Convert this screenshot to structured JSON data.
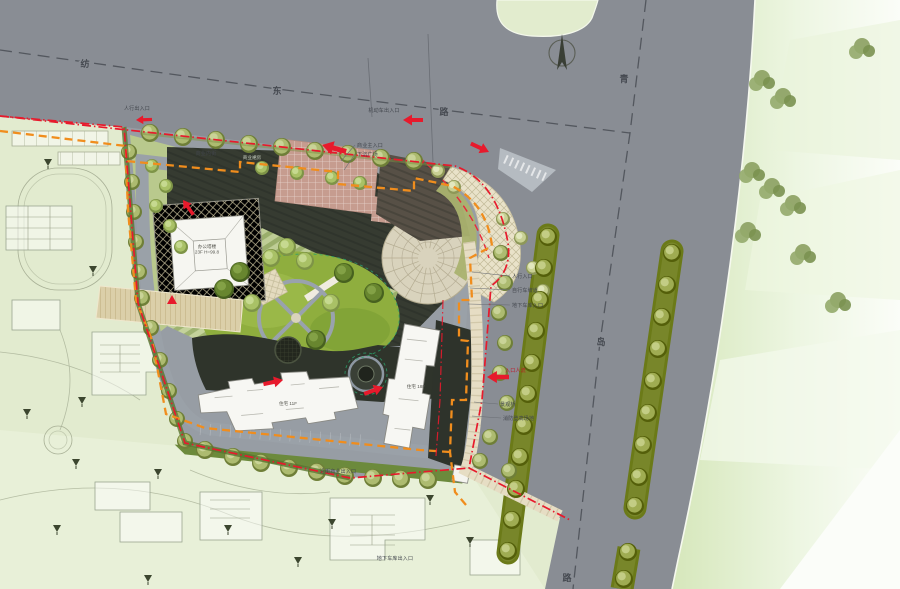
{
  "plan": {
    "type": "architectural-site-master-plan",
    "colors": {
      "road": "#898d94",
      "context_green": "#e2ebcf",
      "field_green": "#dcebc2",
      "garden_green": "#8fae3e",
      "terrace_light": "#c6d59b",
      "terrace_dark": "#9fb46e",
      "shadow_dark": "#363b31",
      "tower_white": "#f6f6f1",
      "plaza_pink": "#c69c8f",
      "fan_cream": "#e9e2c9",
      "median_olive": "#6b7a18",
      "boundary_red": "#e71a2c",
      "fire_lane_orange": "#f08d1d"
    },
    "north_arrow": {
      "x": 562,
      "y": 53
    },
    "road_labels": [
      {
        "text": "纺",
        "x": 85,
        "y": 67
      },
      {
        "text": "东",
        "x": 277,
        "y": 94
      },
      {
        "text": "路",
        "x": 444,
        "y": 115
      },
      {
        "text": "青",
        "x": 624,
        "y": 82
      },
      {
        "text": "岛",
        "x": 601,
        "y": 345
      },
      {
        "text": "路",
        "x": 567,
        "y": 581
      }
    ],
    "annotations": [
      {
        "t": "机动车出入口",
        "x": 384,
        "y": 112,
        "c": "#41454c",
        "anchor": "middle"
      },
      {
        "t": "人行出入口",
        "x": 137,
        "y": 110,
        "c": "#41454c",
        "anchor": "middle"
      },
      {
        "t": "商业主入口",
        "x": 357,
        "y": 147,
        "c": "#41454c",
        "anchor": "start",
        "lx": 341,
        "ly": 161
      },
      {
        "t": "下沉广场",
        "x": 357,
        "y": 156,
        "c": "#41454c",
        "anchor": "start",
        "lx": 344,
        "ly": 170
      },
      {
        "t": "商业内街",
        "x": 206,
        "y": 155,
        "c": "#41454c",
        "anchor": "middle"
      },
      {
        "t": "人行入口",
        "x": 512,
        "y": 278,
        "c": "#41454c",
        "anchor": "start",
        "lx": 472,
        "ly": 272
      },
      {
        "t": "自行车坡道",
        "x": 512,
        "y": 292,
        "c": "#41454c",
        "anchor": "start",
        "lx": 470,
        "ly": 288
      },
      {
        "t": "地下车库入口",
        "x": 512,
        "y": 307,
        "c": "#41454c",
        "anchor": "start",
        "lx": 468,
        "ly": 304
      },
      {
        "t": "入口人流",
        "x": 505,
        "y": 372,
        "c": "#c01325",
        "anchor": "start"
      },
      {
        "t": "景观桥",
        "x": 500,
        "y": 406,
        "c": "#41454c",
        "anchor": "start",
        "lx": 474,
        "ly": 402
      },
      {
        "t": "消防登高场地",
        "x": 503,
        "y": 420,
        "c": "#41454c",
        "anchor": "start",
        "lx": 472,
        "ly": 416
      },
      {
        "t": "沿街商业出入口",
        "x": 338,
        "y": 473,
        "c": "#41454c",
        "anchor": "middle"
      },
      {
        "t": "地下车库出入口",
        "x": 395,
        "y": 560,
        "c": "#41454c",
        "anchor": "middle"
      }
    ],
    "building_labels": [
      {
        "lines": [
          "办公塔楼",
          "23F  H=99.8"
        ],
        "x": 207,
        "y": 248,
        "color": "#55554e"
      },
      {
        "lines": [
          "商业裙房"
        ],
        "x": 252,
        "y": 159,
        "color": "#c7cdbf"
      },
      {
        "lines": [
          "住宅 11F"
        ],
        "x": 288,
        "y": 405,
        "color": "#55554e"
      },
      {
        "lines": [
          "住宅 18F"
        ],
        "x": 416,
        "y": 388,
        "color": "#55554e"
      }
    ],
    "entrance_arrows": [
      {
        "x": 403,
        "y": 120,
        "a": 180,
        "s": 1
      },
      {
        "x": 322,
        "y": 145,
        "a": 195,
        "s": 1.25
      },
      {
        "x": 489,
        "y": 152,
        "a": 25,
        "s": 1
      },
      {
        "x": 487,
        "y": 377,
        "a": 180,
        "s": 1.1
      },
      {
        "x": 283,
        "y": 380,
        "a": -12,
        "s": 1
      },
      {
        "x": 383,
        "y": 387,
        "a": -20,
        "s": 1
      },
      {
        "x": 136,
        "y": 120,
        "a": 178,
        "s": 0.8
      },
      {
        "x": 183,
        "y": 200,
        "a": 235,
        "s": 0.9
      },
      {
        "x": 172,
        "y": 300,
        "a": 0,
        "s": 1,
        "type": "tri"
      }
    ],
    "trees": {
      "site_row_north": {
        "style": "olive",
        "r": 9,
        "pts": [
          [
            150,
            133
          ],
          [
            183,
            137
          ],
          [
            216,
            140
          ],
          [
            249,
            144
          ],
          [
            282,
            147
          ],
          [
            315,
            151
          ],
          [
            348,
            154
          ],
          [
            381,
            158
          ],
          [
            414,
            161
          ]
        ]
      },
      "site_row_west": {
        "style": "olive",
        "r": 8,
        "pts": [
          [
            129,
            152
          ],
          [
            132,
            182
          ],
          [
            134,
            212
          ],
          [
            136,
            242
          ],
          [
            139,
            272
          ],
          [
            142,
            298
          ]
        ]
      },
      "hedge_sw": {
        "style": "olive",
        "r": 8,
        "pts": [
          [
            151,
            328
          ],
          [
            160,
            360
          ],
          [
            169,
            391
          ],
          [
            177,
            419
          ],
          [
            185,
            441
          ]
        ]
      },
      "site_row_south": {
        "style": "olive",
        "r": 9,
        "pts": [
          [
            205,
            450
          ],
          [
            233,
            457
          ],
          [
            261,
            463
          ],
          [
            289,
            468
          ],
          [
            317,
            472
          ],
          [
            345,
            476
          ],
          [
            373,
            478
          ],
          [
            401,
            479
          ],
          [
            428,
            480
          ]
        ]
      },
      "nw_wedge": {
        "style": "light",
        "r": 7,
        "pts": [
          [
            152,
            166
          ],
          [
            166,
            186
          ],
          [
            156,
            206
          ],
          [
            170,
            226
          ],
          [
            181,
            247
          ]
        ]
      },
      "north_street": {
        "style": "light",
        "r": 7,
        "pts": [
          [
            262,
            168
          ],
          [
            297,
            173
          ],
          [
            332,
            178
          ],
          [
            360,
            183
          ]
        ]
      },
      "garden_dark": {
        "style": "dark",
        "r": 10,
        "pts": [
          [
            240,
            272
          ],
          [
            344,
            273
          ],
          [
            374,
            293
          ],
          [
            224,
            289
          ],
          [
            316,
            340
          ]
        ]
      },
      "garden_light": {
        "style": "light",
        "r": 9,
        "pts": [
          [
            271,
            258
          ],
          [
            305,
            261
          ],
          [
            331,
            303
          ],
          [
            252,
            303
          ],
          [
            287,
            247
          ]
        ]
      },
      "fan_area": {
        "style": "cream",
        "r": 7,
        "pts": [
          [
            438,
            171
          ],
          [
            454,
            187
          ],
          [
            521,
            238
          ],
          [
            533,
            268
          ],
          [
            543,
            291
          ],
          [
            503,
            219
          ]
        ]
      },
      "east_walk": {
        "style": "olive",
        "r": 8,
        "pts": [
          [
            501,
            253
          ],
          [
            505,
            283
          ],
          [
            499,
            313
          ],
          [
            505,
            343
          ],
          [
            500,
            373
          ],
          [
            507,
            403
          ],
          [
            490,
            437
          ],
          [
            480,
            461
          ],
          [
            509,
            471
          ]
        ]
      },
      "median1": {
        "style": "median",
        "r": 9,
        "pts": [
          [
            548,
            237
          ],
          [
            544,
            268
          ],
          [
            540,
            300
          ],
          [
            536,
            331
          ],
          [
            532,
            363
          ],
          [
            528,
            394
          ],
          [
            524,
            426
          ],
          [
            520,
            457
          ],
          [
            516,
            489
          ],
          [
            512,
            520
          ],
          [
            508,
            551
          ]
        ]
      },
      "median2": {
        "style": "median",
        "r": 9,
        "pts": [
          [
            672,
            253
          ],
          [
            667,
            285
          ],
          [
            662,
            317
          ],
          [
            658,
            349
          ],
          [
            653,
            381
          ],
          [
            648,
            413
          ],
          [
            643,
            445
          ],
          [
            639,
            477
          ],
          [
            635,
            506
          ],
          [
            628,
            552
          ],
          [
            624,
            579
          ]
        ]
      },
      "field_clusters": [
        [
          762,
          78
        ],
        [
          783,
          96
        ],
        [
          752,
          170
        ],
        [
          772,
          186
        ],
        [
          793,
          203
        ],
        [
          748,
          230
        ],
        [
          803,
          252
        ],
        [
          862,
          46
        ],
        [
          838,
          300
        ]
      ],
      "context_triangles": [
        [
          48,
          162
        ],
        [
          93,
          269
        ],
        [
          27,
          412
        ],
        [
          82,
          400
        ],
        [
          76,
          462
        ],
        [
          57,
          528
        ],
        [
          148,
          578
        ],
        [
          228,
          528
        ],
        [
          158,
          472
        ],
        [
          332,
          522
        ],
        [
          298,
          560
        ],
        [
          470,
          540
        ],
        [
          430,
          498
        ]
      ]
    }
  }
}
